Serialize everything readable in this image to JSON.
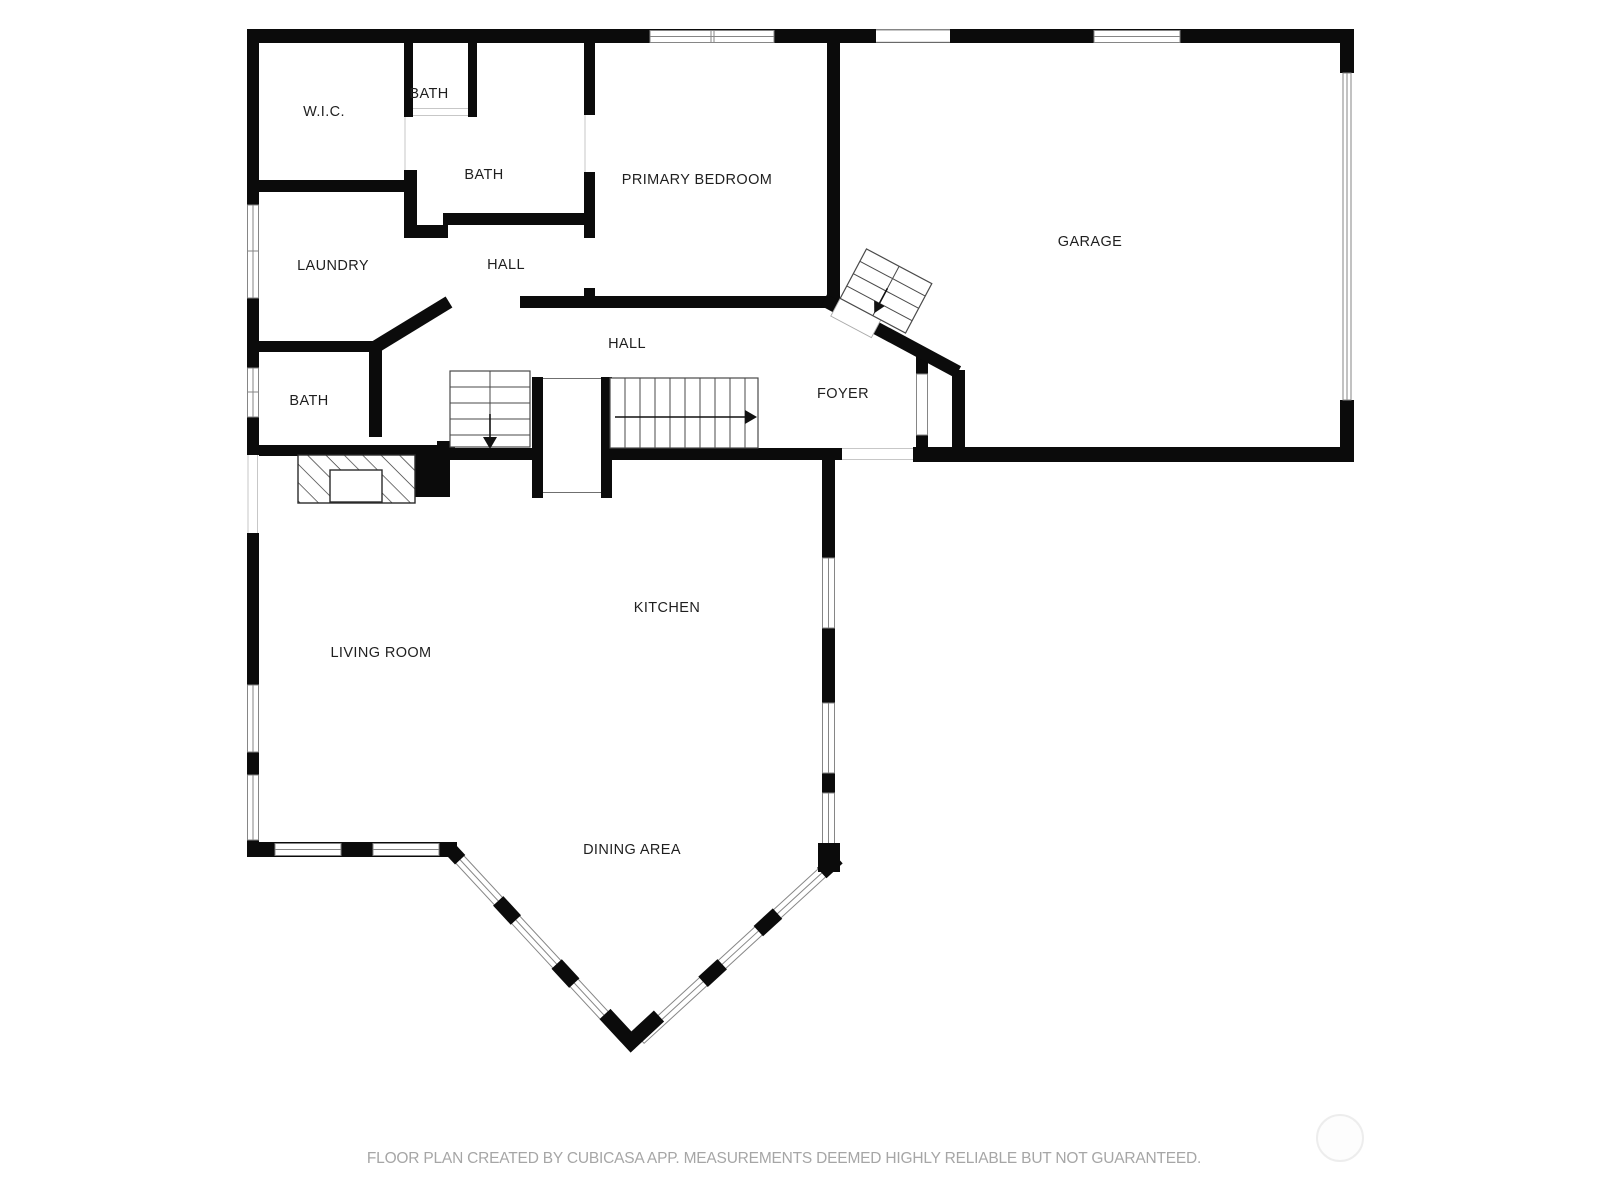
{
  "floor_plan": {
    "labels": {
      "wic": "W.I.C.",
      "bath_top": "BATH",
      "bath_main": "BATH",
      "primary_bedroom": "PRIMARY BEDROOM",
      "garage": "GARAGE",
      "laundry": "LAUNDRY",
      "hall_upper": "HALL",
      "hall_lower": "HALL",
      "foyer": "FOYER",
      "bath_lower": "BATH",
      "kitchen": "KITCHEN",
      "living_room": "LIVING ROOM",
      "dining_area": "DINING AREA"
    },
    "footer": "FLOOR PLAN CREATED BY CUBICASA APP. MEASUREMENTS DEEMED HIGHLY RELIABLE BUT NOT GUARANTEED.",
    "colors": {
      "wall": "#0b0b0b",
      "background": "#ffffff",
      "label_text": "#1f1f1f",
      "footer_text": "#a6a6a6",
      "window_border": "#868686"
    }
  }
}
